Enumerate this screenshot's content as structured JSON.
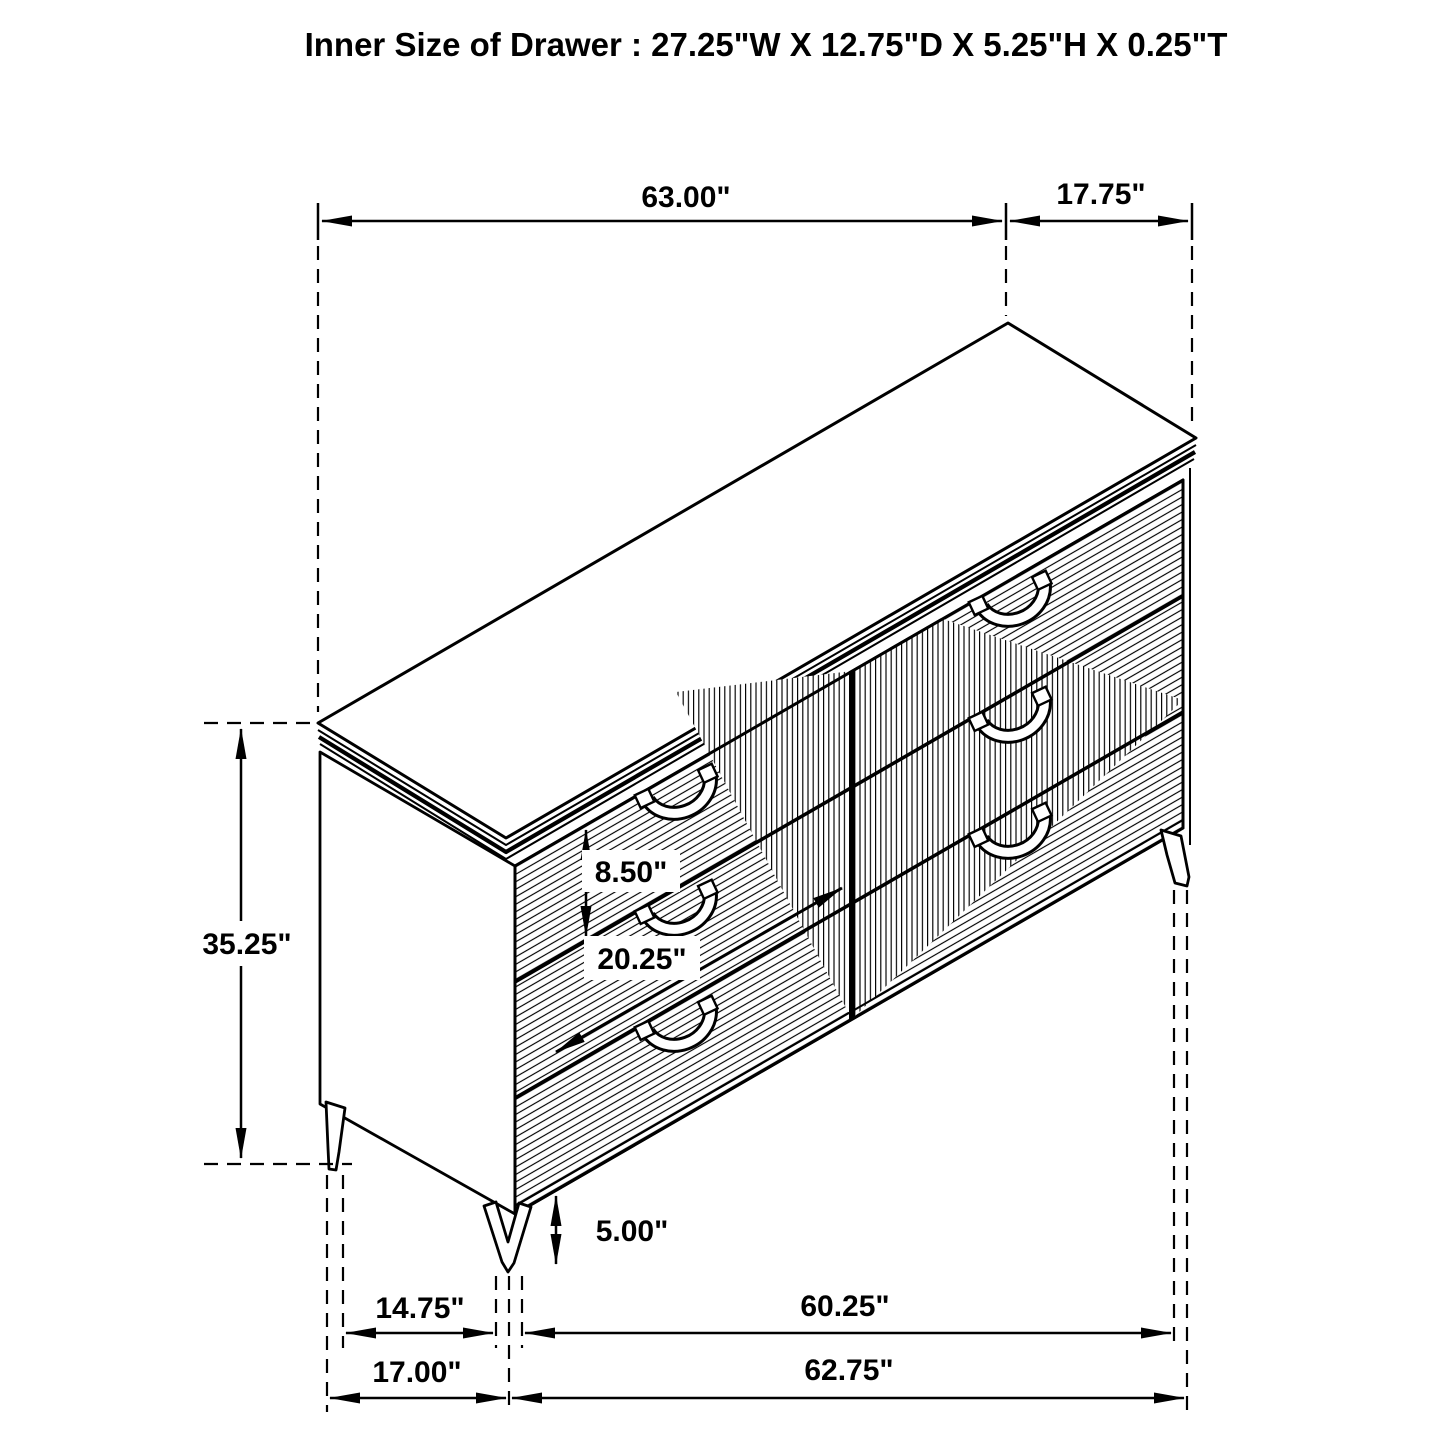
{
  "title": "Inner Size of Drawer : 27.25\"W X 12.75\"D X 5.25\"H X 0.25\"T",
  "colors": {
    "line": "#000000",
    "background": "#ffffff"
  },
  "dimensions": {
    "top_width": "63.00\"",
    "top_depth": "17.75\"",
    "overall_height": "35.25\"",
    "top_drawer_height": "8.50\"",
    "drawer_opening_width": "20.25\"",
    "floor_clearance": "5.00\"",
    "leg_span_depth_inner": "14.75\"",
    "leg_span_width_inner": "60.25\"",
    "leg_span_depth_outer": "17.00\"",
    "leg_span_width_outer": "62.75\""
  }
}
